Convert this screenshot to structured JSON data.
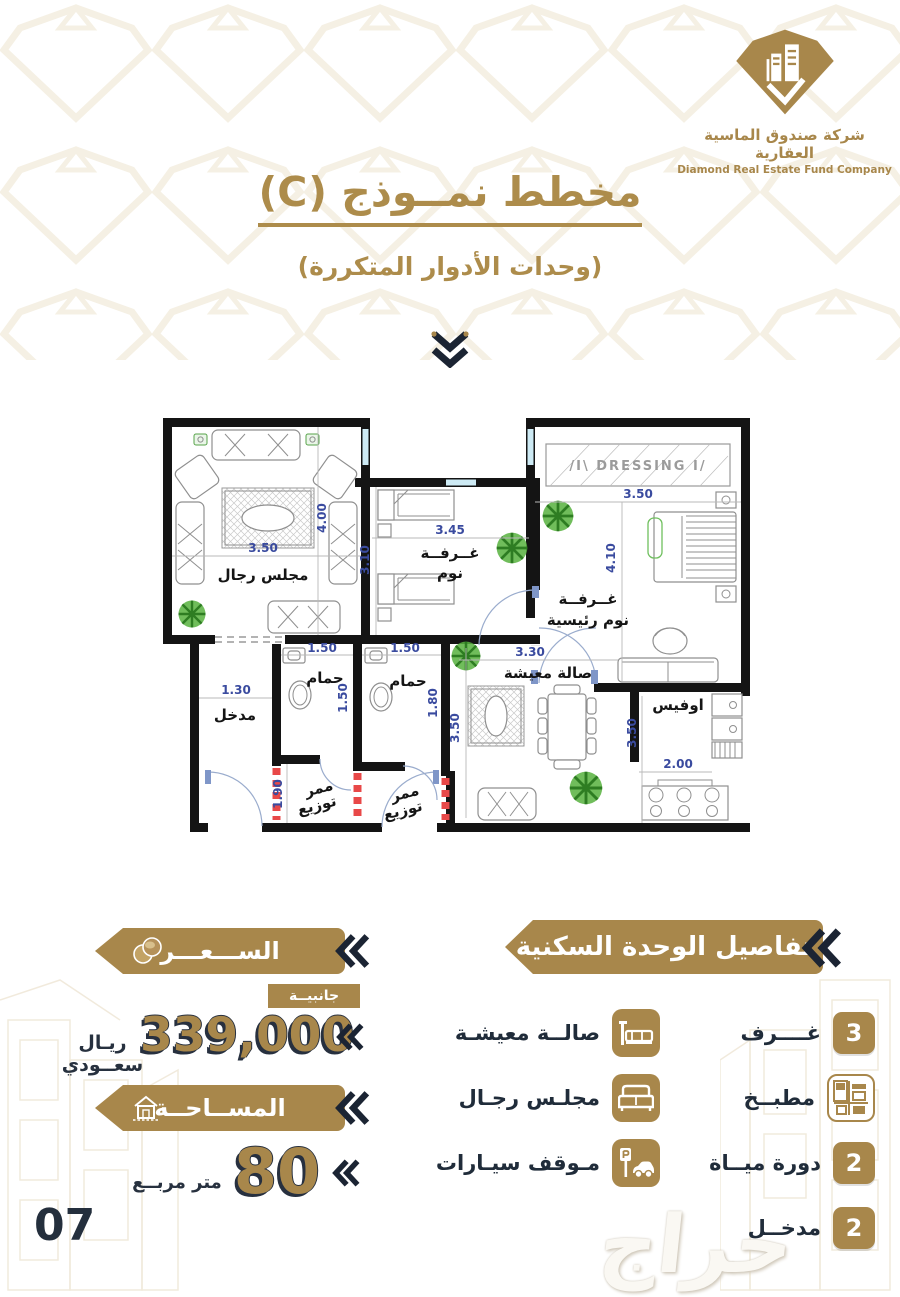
{
  "logo": {
    "company_ar": "شركة صندوق الماسية العقارية",
    "company_en": "Diamond Real Estate Fund Company"
  },
  "header": {
    "title": "مخطط نمــوذج (C)",
    "subtitle": "(وحدات الأدوار المتكررة)"
  },
  "plan": {
    "majlis": {
      "label": "مجلس رجال",
      "w": "3.50",
      "h": "4.00"
    },
    "bedroom": {
      "l1": "غــرفــة",
      "l2": "نوم",
      "w": "3.45",
      "h": "3.10"
    },
    "master": {
      "l1": "غــرفــة",
      "l2": "نوم رئيسية",
      "w": "3.50",
      "h": "4.10"
    },
    "dressing": "/I\\ DRESSING I/",
    "entrance": {
      "label": "مدخل",
      "w": "1.30"
    },
    "bath1": {
      "label": "حمام",
      "w": "1.50",
      "h": "1.50"
    },
    "bath2": {
      "label": "حمام",
      "w": "1.50",
      "h": "1.80"
    },
    "hall1": {
      "l1": "ممر",
      "l2": "توزيع",
      "h": "1.90"
    },
    "hall2": {
      "l1": "ممر",
      "l2": "توزيع"
    },
    "living": {
      "label": "صالة معيشة",
      "w": "3.30",
      "h": "3.50"
    },
    "office": {
      "label": "اوفيس",
      "w": "2.00",
      "h": "3.50"
    }
  },
  "price": {
    "banner": "الســـعـــر",
    "tag": "جانبيــة",
    "amount": "339,000",
    "currency": "ريـال سعــودي"
  },
  "area": {
    "banner": "المســاحــة",
    "value": "80",
    "unit": "متر مربــع"
  },
  "details": {
    "banner": "تفاصيل الوحدة السكنية",
    "col_right": [
      {
        "badge": "3",
        "label": "غــــرف"
      },
      {
        "badge": "",
        "label": "مطبــخ"
      },
      {
        "badge": "2",
        "label": "دورة ميــاة"
      },
      {
        "badge": "2",
        "label": "مدخــل"
      }
    ],
    "col_left": [
      {
        "label": "صالــة معيشـة"
      },
      {
        "label": "مجلـس رجـال"
      },
      {
        "label": "مـوقف سيـارات"
      }
    ]
  },
  "footer": {
    "page": "07",
    "watermark": "حراج"
  }
}
